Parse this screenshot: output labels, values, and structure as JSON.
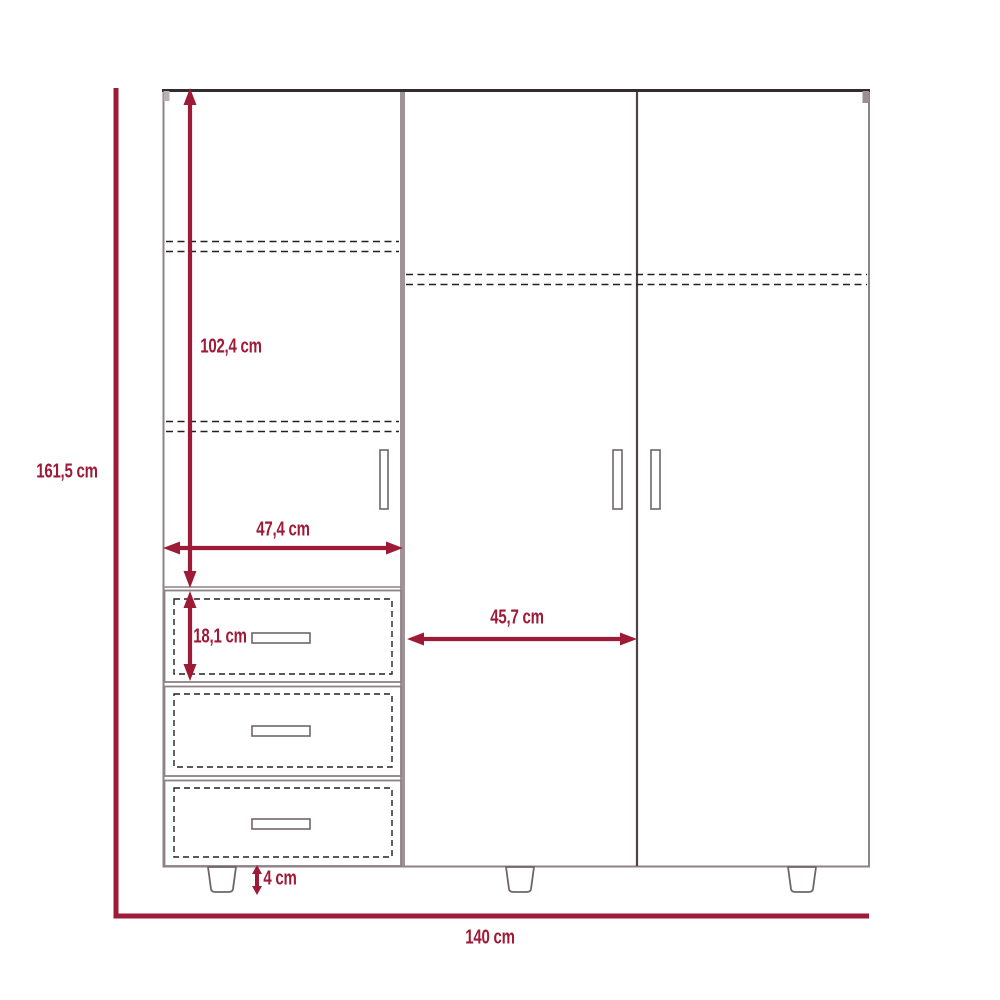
{
  "diagram": {
    "kind": "furniture-technical-drawing",
    "subject": "three-door wardrobe with three drawers and legs",
    "colors": {
      "dimension_accent": "#9e1b38",
      "outline_gray": "#8d8286",
      "outline_dark": "#332b2e",
      "dashed_line": "#232021"
    },
    "dimensions": {
      "overall_height": "161,5 cm",
      "door_section_height": "102,4 cm",
      "left_section_width": "47,4 cm",
      "drawer_height": "18,1 cm",
      "door_width": "45,7 cm",
      "leg_height": "4 cm",
      "overall_width": "140 cm"
    }
  }
}
